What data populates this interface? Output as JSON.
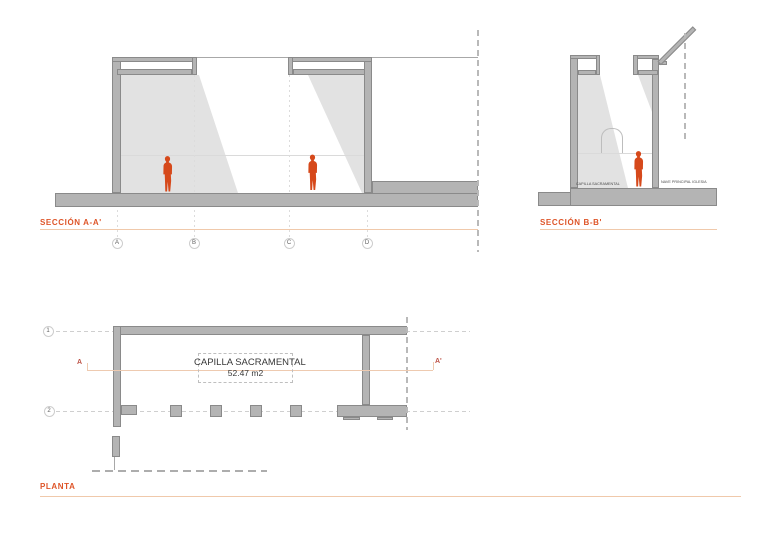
{
  "sections": {
    "aa": {
      "label": "SECCIÓN A-A'",
      "grid_bubbles": [
        "A",
        "B",
        "C",
        "D"
      ]
    },
    "bb": {
      "label": "SECCIÓN B-B'",
      "floor_label_left": "CAPILLA SACRAMENTAL",
      "floor_label_right": "NAVE PRINCIPAL IGLESIA"
    }
  },
  "plan": {
    "label": "PLANTA",
    "room_name": "CAPILLA SACRAMENTAL",
    "room_area": "52.47 m2",
    "grid_rows": [
      "1",
      "2"
    ],
    "section_marker_start": "A",
    "section_marker_end": "A'"
  },
  "colors": {
    "accent_orange": "#DE5529",
    "accent_orange_light": "#F0C9AB",
    "marker_red": "#BD5347",
    "figure_orange": "#D6491B",
    "wall_gray": "#B4B4B4",
    "wall_outline": "#8A8A8A",
    "shadow_gray": "#E2E2E2"
  }
}
